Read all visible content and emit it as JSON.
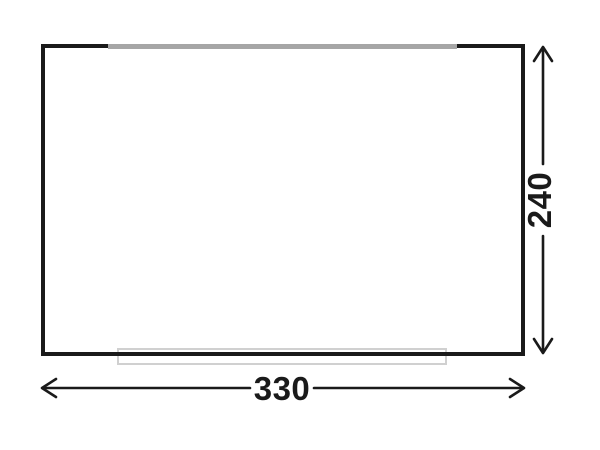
{
  "page": {
    "background_color": "#ffffff"
  },
  "plan": {
    "outline_color": "#1a1a1a",
    "top_opening_color": "#a6a6a6",
    "door_marker_color": "#d0d0d0"
  },
  "dimensions": {
    "arrow_color": "#1a1a1a",
    "width": {
      "value": "330",
      "orientation": "horizontal"
    },
    "height": {
      "value": "240",
      "orientation": "vertical"
    }
  }
}
